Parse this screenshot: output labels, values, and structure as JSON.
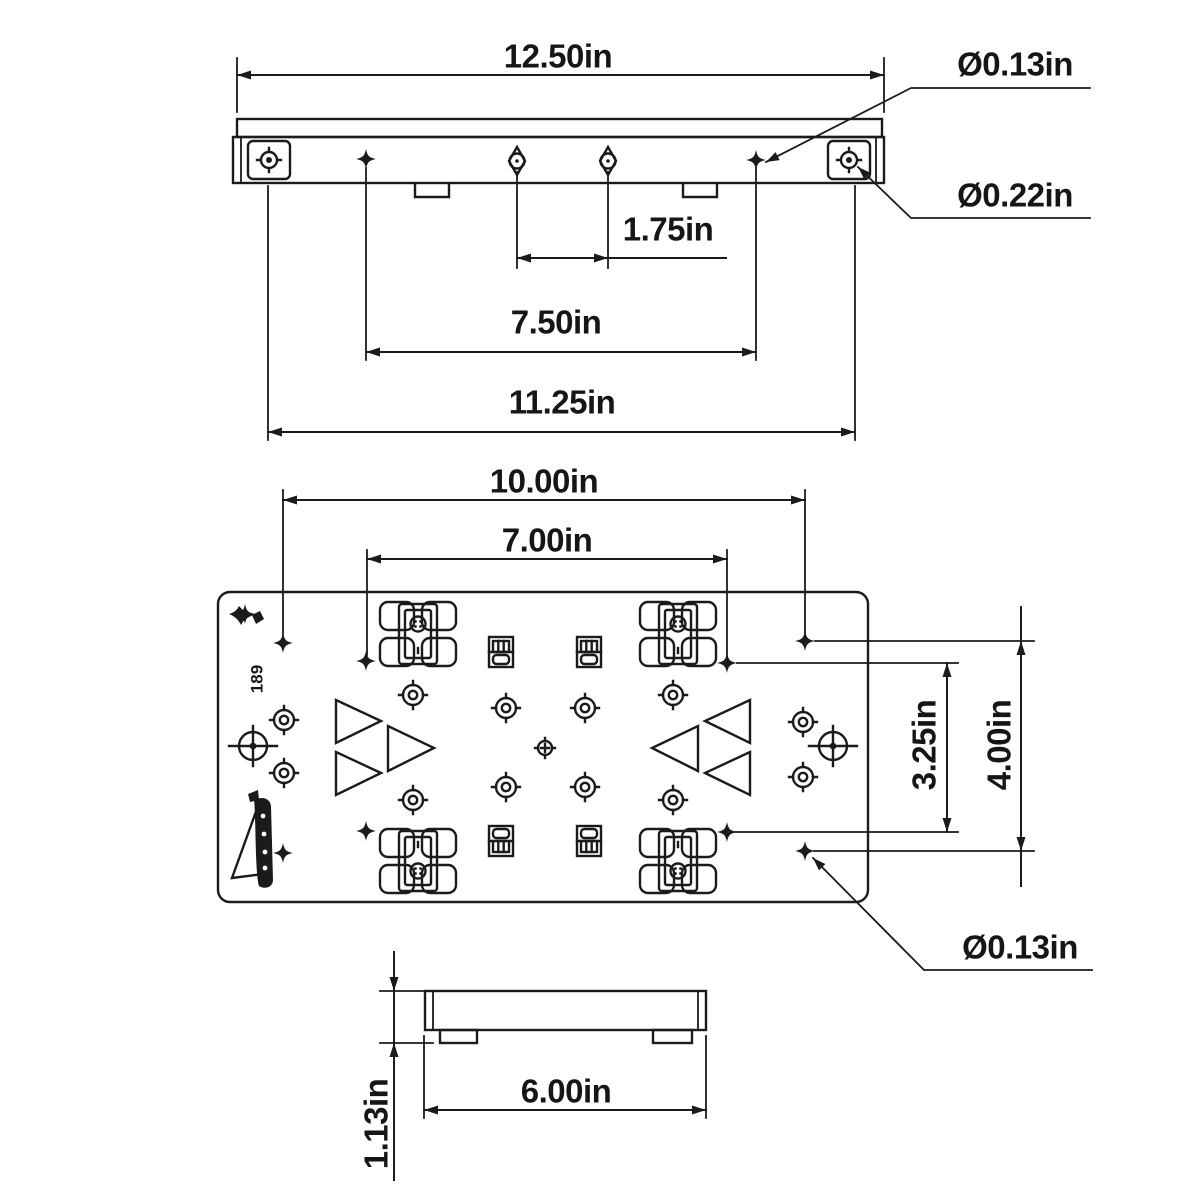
{
  "style": {
    "background": "#ffffff",
    "line_color": "#1b1b1b"
  },
  "side_view": {
    "dim_overall_width": "12.50in",
    "dia_small_hole": "Ø0.13in",
    "dia_large_hole": "Ø0.22in",
    "dim_center_hole_spacing": "1.75in",
    "dim_slot_hole_spacing": "7.50in",
    "dim_end_hole_spacing": "11.25in"
  },
  "top_view": {
    "dim_outer_holes_width": "10.00in",
    "dim_inner_holes_width": "7.00in",
    "dim_inner_holes_height": "3.25in",
    "dim_outer_holes_height": "4.00in",
    "dia_corner_hole": "Ø0.13in",
    "plate_marking": "189"
  },
  "front_view": {
    "dim_feet_spacing": "6.00in",
    "dim_height": "1.13in"
  }
}
